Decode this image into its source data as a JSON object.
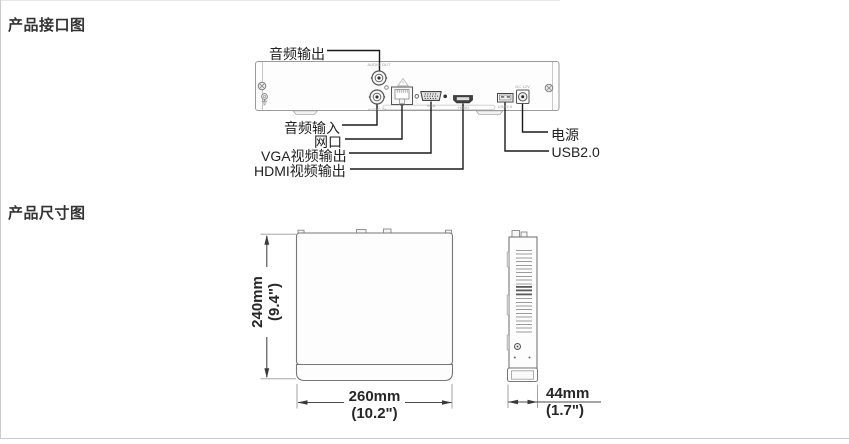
{
  "page": {
    "background": "#ffffff",
    "frame_border_color": "#cccccc"
  },
  "interface_section": {
    "title": "产品接口图",
    "port_labels": {
      "audio_out": "音频输出",
      "audio_in": "音频输入",
      "lan": "网口",
      "vga": "VGA视频输出",
      "hdmi": "HDMI视频输出",
      "power": "电源",
      "usb": "USB2.0"
    },
    "panel_micro_labels": {
      "audio_out": "AUDIO OUT",
      "audio_in": "AUDIO IN",
      "vga": "VGA",
      "hdmi": "HDMI",
      "usb": "USB2.0",
      "dc_power": "DC 12V"
    }
  },
  "dimension_section": {
    "title": "产品尺寸图",
    "height": {
      "mm": "240mm",
      "inch": "(9.4\")"
    },
    "width": {
      "mm": "260mm",
      "inch": "(10.2\")"
    },
    "depth": {
      "mm": "44mm",
      "inch": "(1.7\")"
    }
  }
}
